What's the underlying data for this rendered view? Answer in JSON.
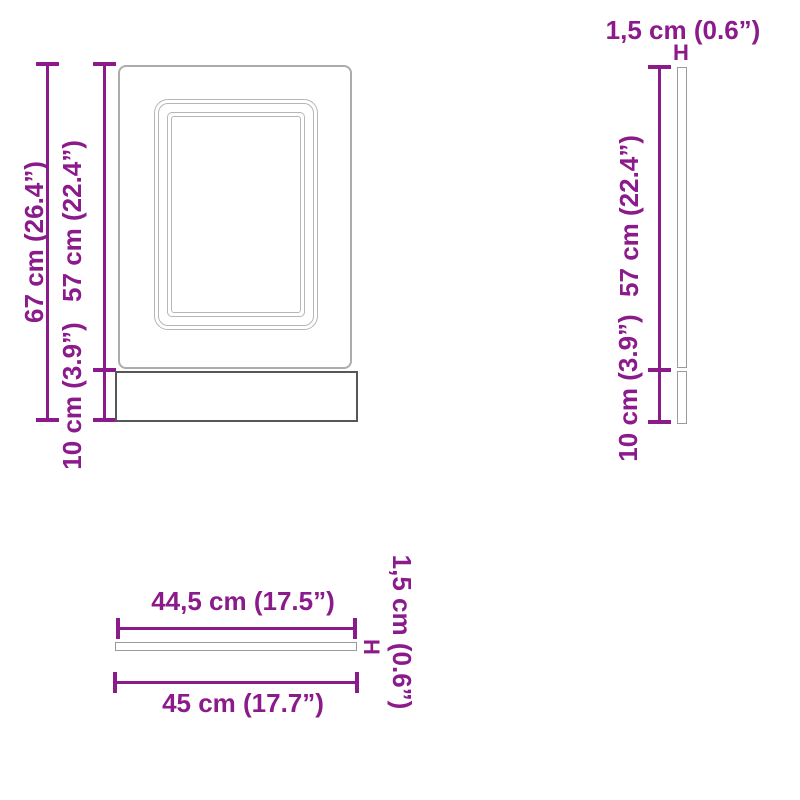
{
  "colors": {
    "dimension": "#8B1A8B",
    "door_outline": "#ACACAC",
    "frame_line": "#B6B6B6",
    "plinth_outline": "#575757",
    "thin_panel_outline": "#9A9A9A",
    "background": "#FFFFFF"
  },
  "front_view": {
    "total_height_label": "67 cm (26.4”)",
    "door_height_label": "57 cm (22.4”)",
    "plinth_height_label": "10 cm (3.9”)"
  },
  "side_view": {
    "thickness_label": "1,5 cm (0.6”)",
    "thickness_marker": "H",
    "door_height_label": "57 cm (22.4”)",
    "plinth_height_label": "10 cm (3.9”)"
  },
  "top_view": {
    "door_width_label": "44,5 cm (17.5”)",
    "total_width_label": "45 cm (17.7”)",
    "thickness_label": "1,5 cm (0.6”)",
    "thickness_marker": "H"
  }
}
